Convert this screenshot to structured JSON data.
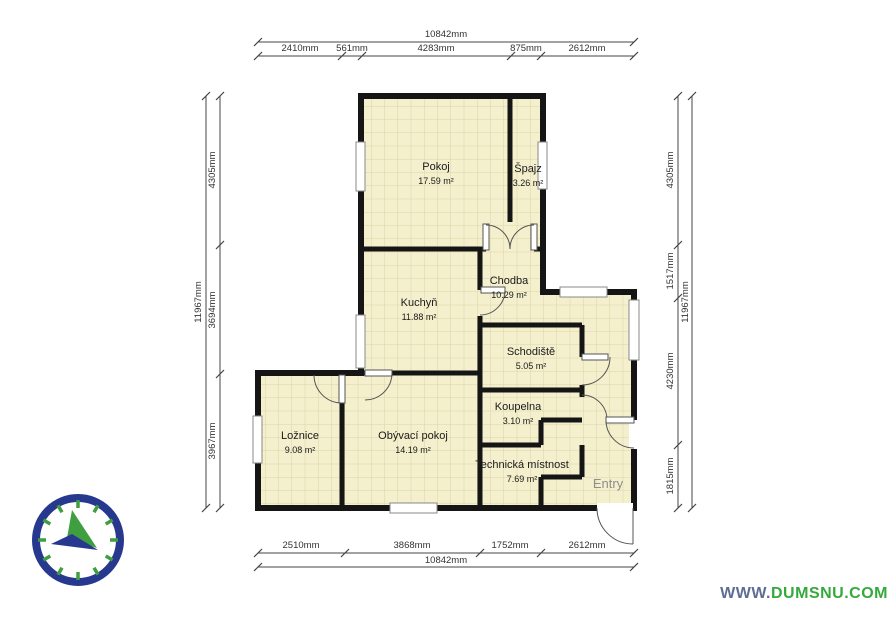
{
  "rooms": [
    {
      "name": "Pokoj",
      "area": "17.59 m²"
    },
    {
      "name": "Špajz",
      "area": "3.26 m²"
    },
    {
      "name": "Chodba",
      "area": "10.29 m²"
    },
    {
      "name": "Kuchyň",
      "area": "11.88 m²"
    },
    {
      "name": "Schodiště",
      "area": "5.05 m²"
    },
    {
      "name": "Koupelna",
      "area": "3.10 m²"
    },
    {
      "name": "Ložnice",
      "area": "9.08 m²"
    },
    {
      "name": "Obývací pokoj",
      "area": "14.19 m²"
    },
    {
      "name": "Technická místnost",
      "area": "7.69 m²"
    },
    {
      "name": "Entry",
      "area": ""
    }
  ],
  "dimensions": {
    "top_total": "10842mm",
    "top_segments": [
      "2410mm",
      "561mm",
      "4283mm",
      "875mm",
      "2612mm"
    ],
    "bottom_segments": [
      "2510mm",
      "3868mm",
      "1752mm",
      "2612mm"
    ],
    "bottom_total": "10842mm",
    "left_total": "11967mm",
    "left_segments": [
      "4305mm",
      "3694mm",
      "3967mm"
    ],
    "right_segments": [
      "4305mm",
      "1517mm",
      "4230mm",
      "1815mm"
    ],
    "right_total": "11967mm"
  },
  "watermark": {
    "prefix": "WWW.",
    "name": "DUMSNU",
    "suffix": ".COM"
  },
  "colors": {
    "floor": "#f4efcd",
    "floor_grid": "#dcd5a8",
    "wall": "#151515",
    "compass_ring": "#27388f",
    "compass_green": "#3f9e3f",
    "watermark_blue": "#5d6d93",
    "watermark_green": "#36a93c"
  }
}
